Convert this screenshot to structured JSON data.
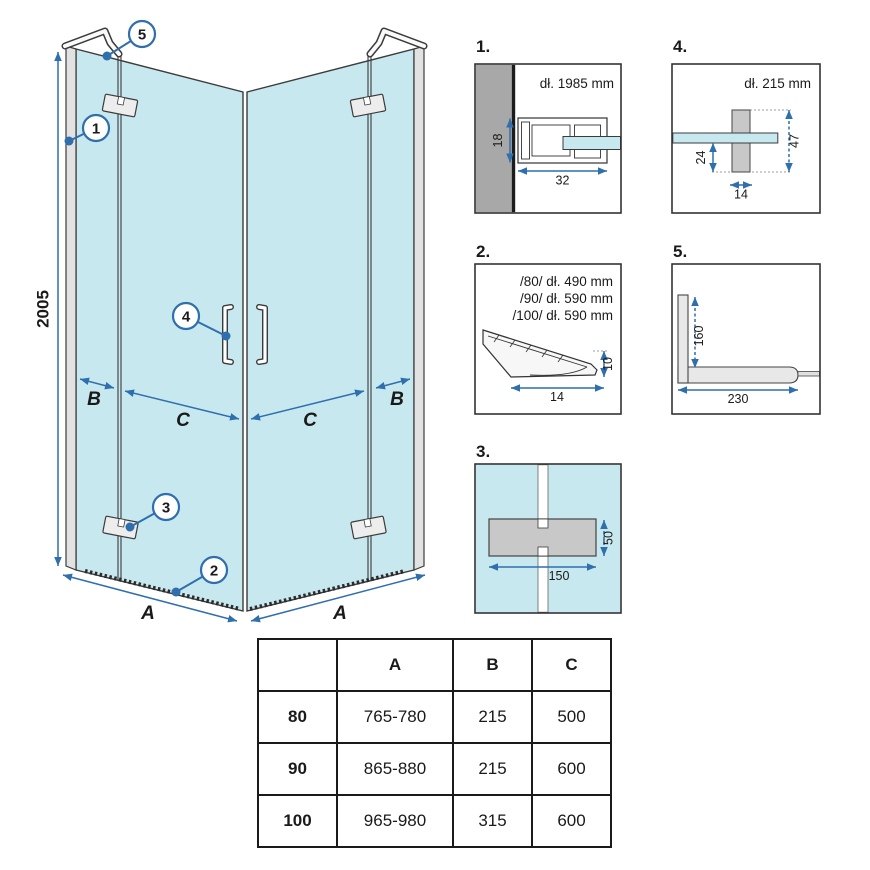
{
  "main": {
    "dims": {
      "height": "2005",
      "a_left": "A",
      "a_right": "A",
      "b_left": "B",
      "b_right": "B",
      "c_left": "C",
      "c_right": "C"
    },
    "callouts": {
      "c1": "1",
      "c2": "2",
      "c3": "3",
      "c4": "4",
      "c5": "5"
    }
  },
  "details": {
    "d1": {
      "label": "1.",
      "length": "dł. 1985 mm",
      "dim_depth": "18",
      "dim_width": "32"
    },
    "d4": {
      "label": "4.",
      "length": "dł. 215 mm",
      "dim_offset": "24",
      "dim_height": "47",
      "dim_width": "14"
    },
    "d2": {
      "label": "2.",
      "lengths": [
        "/80/ dł. 490 mm",
        "/90/ dł. 590 mm",
        "/100/ dł. 590 mm"
      ],
      "dim_height": "10",
      "dim_width": "14"
    },
    "d5": {
      "label": "5.",
      "dim_vertical": "160",
      "dim_horizontal": "230"
    },
    "d3": {
      "label": "3.",
      "dim_height": "50",
      "dim_width": "150"
    }
  },
  "table": {
    "headers": [
      "",
      "A",
      "B",
      "C"
    ],
    "rows": [
      {
        "label": "80",
        "a": "765-780",
        "b": "215",
        "c": "500"
      },
      {
        "label": "90",
        "a": "865-880",
        "b": "215",
        "c": "600"
      },
      {
        "label": "100",
        "a": "965-980",
        "b": "315",
        "c": "600"
      }
    ]
  },
  "colors": {
    "glass_blue": "#c7e8ef",
    "dimension_blue": "#2f6fad",
    "outline_dark": "#3b3b3b",
    "wall_gray": "#a8a8a8",
    "hardware_gray": "#c8c8c8"
  }
}
